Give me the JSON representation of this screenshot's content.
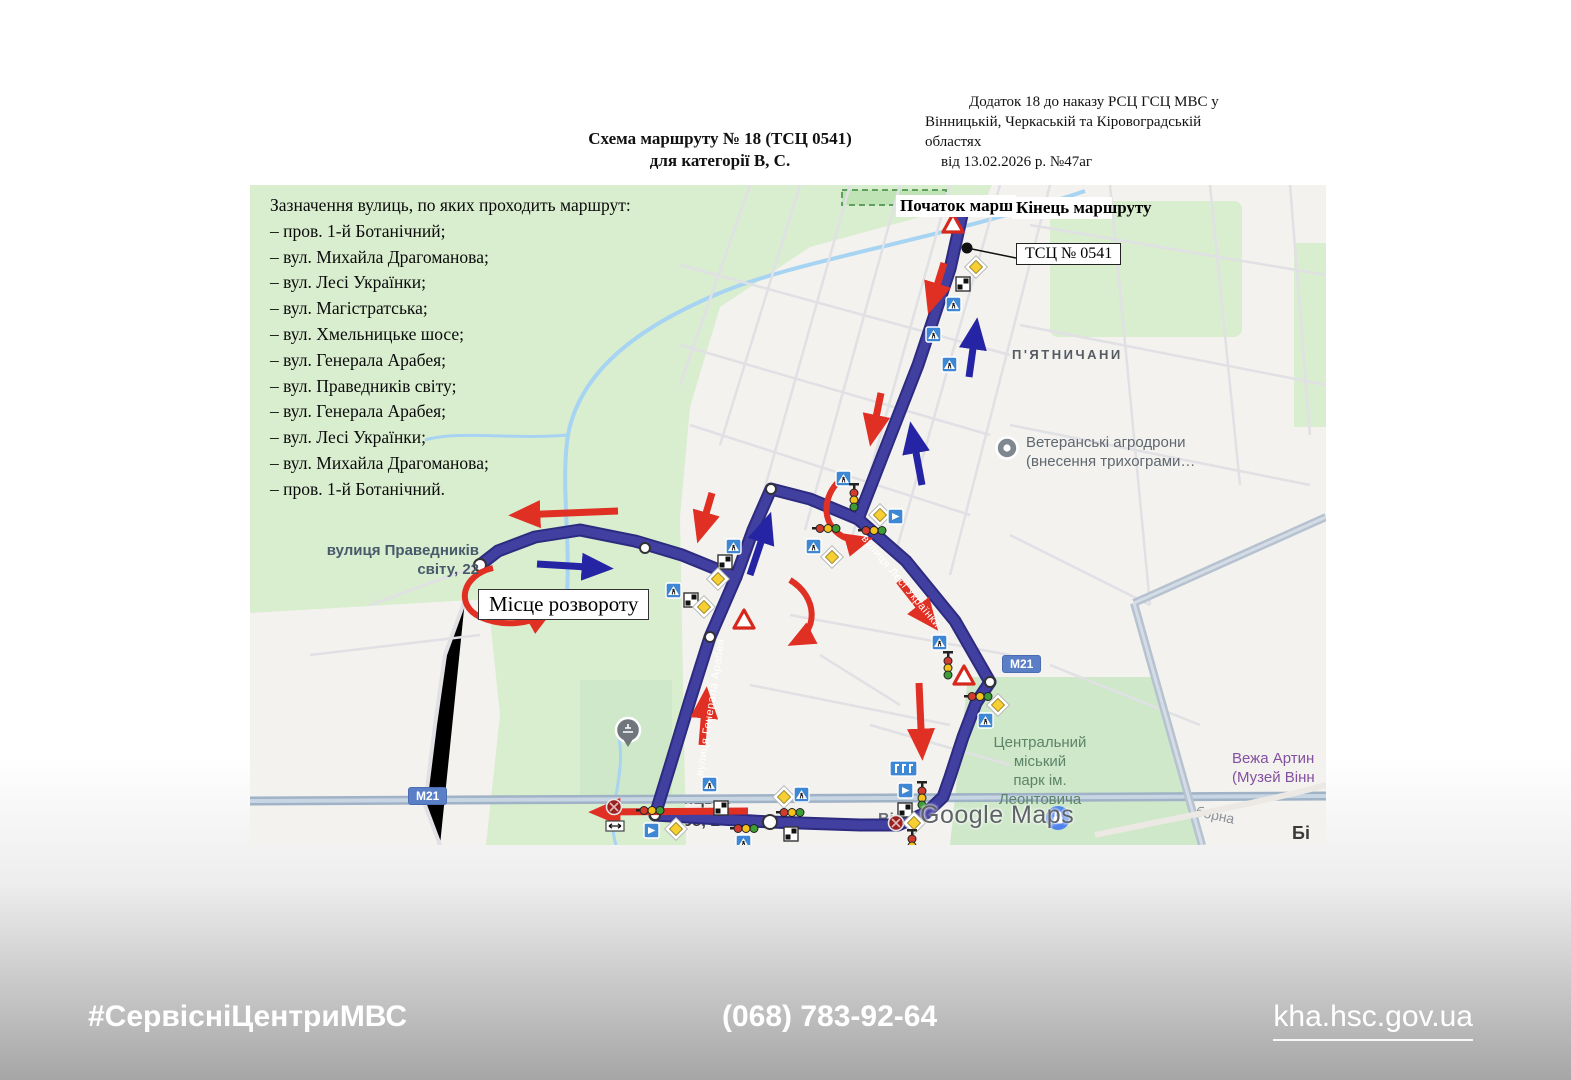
{
  "header": {
    "title_line1": "Схема маршруту № 18 (ТСЦ 0541)",
    "title_line2": "для категорії В, С.",
    "annex_line1": "Додаток 18 до наказу РСЦ ГСЦ МВС у",
    "annex_line2": "Вінницькій, Черкаській та Кіровоградській",
    "annex_line3": "областях",
    "annex_line4": "від 13.02.2026 р. №47аг"
  },
  "streets": {
    "heading": "Зазначення вулиць, по яких проходить маршрут:",
    "items": [
      "– пров. 1-й Ботанічний;",
      "– вул. Михайла Драгоманова;",
      "– вул. Лесі Українки;",
      "– вул. Магістратська;",
      "– вул. Хмельницьке шосе;",
      "– вул. Генерала Арабея;",
      "– вул. Праведників світу;",
      "– вул. Генерала Арабея;",
      "– вул. Лесі Українки;",
      "– вул. Михайла Драгоманова;",
      "– пров. 1-й Ботанічний."
    ]
  },
  "map": {
    "labels": {
      "start": "Початок маршруту",
      "end": "Кінець маршруту",
      "tsc_box": "ТСЦ № 0541",
      "service_partial": "Серві",
      "district": "П'ЯТНИЧАНИ",
      "poi_agro_line1": "Ветеранські агродрони",
      "poi_agro_line2": "(внесення трихограми…",
      "address_line1": "вулиця Праведників",
      "address_line2": "світу, 22",
      "turn_box": "Місце розвороту",
      "street_pravednykiv": "вул. Праведників світу",
      "street_arabeya": "вулиця Генерала Арабея",
      "street_ukrainky": "вулиця Лесі Українки",
      "street_soborna": "вулиця Соборна",
      "m21": "М21",
      "tower_line1": "Вежа Артин",
      "tower_line2": "(Музей Вінн",
      "park_line1": "Центральний",
      "park_line2": "міський",
      "park_line3": "парк ім.",
      "park_line4": "Леонтовича",
      "khmelnytske_line1": "Хмельницьке",
      "khmelnytske_line2": "шосе, 2",
      "city_partial": "Вінни",
      "corner_partial": "Бі",
      "watermark": "Google Maps"
    },
    "colors": {
      "route": "#413fa0",
      "route_edge": "#2c2b80",
      "arrow_red": "#e02f23",
      "arrow_blue": "#2424a4",
      "green_area": "#d9edcf",
      "m21_badge": "#5b7fc7",
      "highway": "#9fb2c6"
    }
  },
  "footer": {
    "hashtag": "#СервісніЦентриМВС",
    "phone": "(068) 783-92-64",
    "website": "kha.hsc.gov.ua"
  }
}
